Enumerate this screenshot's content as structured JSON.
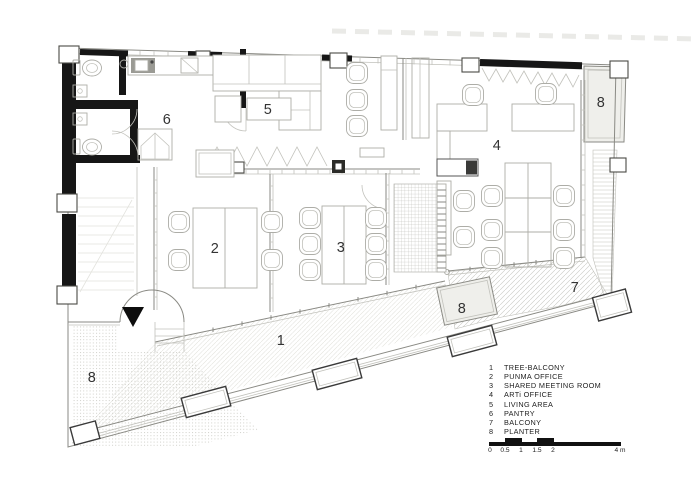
{
  "plan": {
    "room_labels": [
      {
        "num": "1",
        "room": "tree-balcony"
      },
      {
        "num": "2",
        "room": "punma-office"
      },
      {
        "num": "3",
        "room": "shared-meeting-room"
      },
      {
        "num": "4",
        "room": "arti-office"
      },
      {
        "num": "5",
        "room": "living-area"
      },
      {
        "num": "6",
        "room": "pantry"
      },
      {
        "num": "7",
        "room": "balcony"
      },
      {
        "num": "8",
        "room": "planter-top-right"
      },
      {
        "num": "8",
        "room": "planter-mid"
      },
      {
        "num": "8",
        "room": "planter-bottom-left"
      }
    ]
  },
  "legend": {
    "items": [
      {
        "num": "1",
        "label": "TREE-BALCONY"
      },
      {
        "num": "2",
        "label": "PUNMA OFFICE"
      },
      {
        "num": "3",
        "label": "SHARED MEETING ROOM"
      },
      {
        "num": "4",
        "label": "ARTi OFFICE"
      },
      {
        "num": "5",
        "label": "LIVING AREA"
      },
      {
        "num": "6",
        "label": "PANTRY"
      },
      {
        "num": "7",
        "label": "BALCONY"
      },
      {
        "num": "8",
        "label": "PLANTER"
      }
    ]
  },
  "scalebar": {
    "tick_labels": [
      "0",
      "0.5",
      "1",
      "1.5",
      "2"
    ],
    "end_label": "4 m"
  },
  "colors": {
    "wall": "#161616",
    "line": "#8a8a84",
    "text": "#2e2e2e",
    "planter_fill": "#efefeb"
  }
}
